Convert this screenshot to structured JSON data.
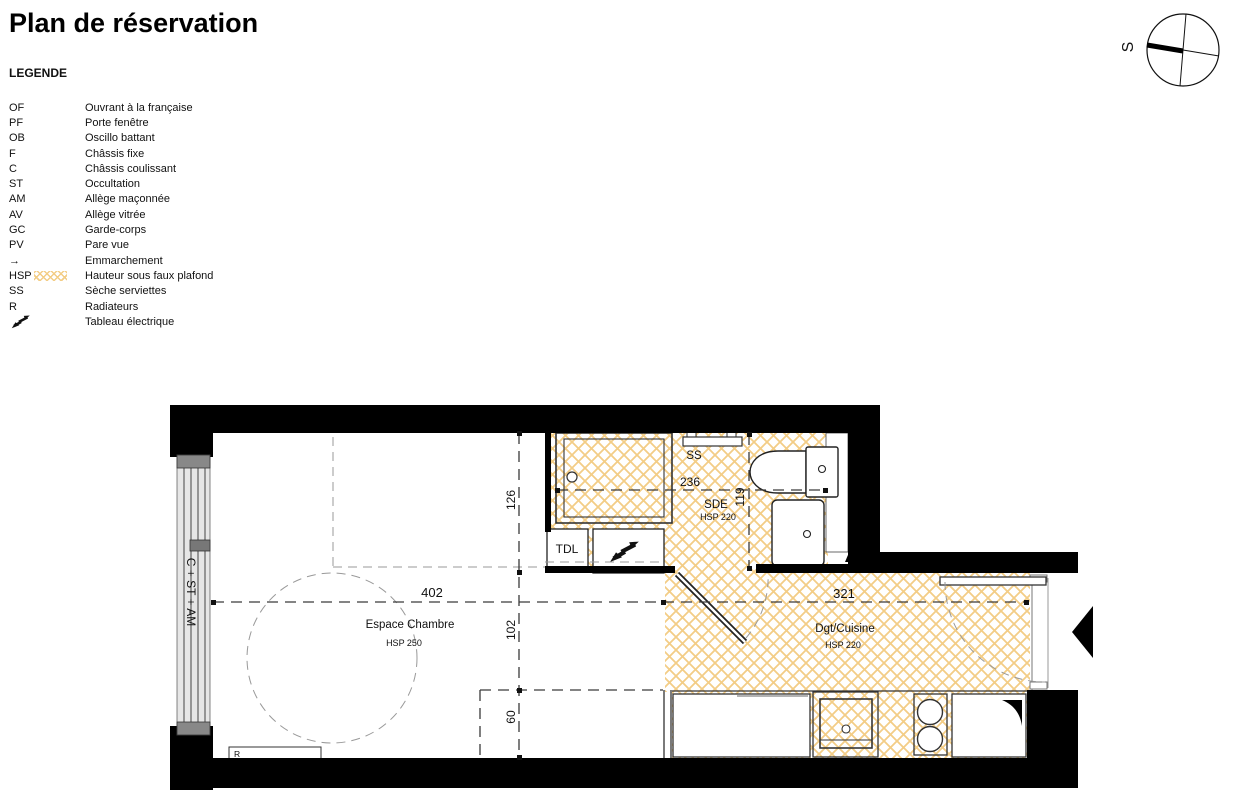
{
  "title": "Plan de réservation",
  "legend": {
    "heading": "LEGENDE",
    "items": [
      {
        "code": "OF",
        "label": "Ouvrant à la française"
      },
      {
        "code": "PF",
        "label": "Porte fenêtre"
      },
      {
        "code": "OB",
        "label": "Oscillo battant"
      },
      {
        "code": "F",
        "label": "Châssis fixe"
      },
      {
        "code": "C",
        "label": "Châssis coulissant"
      },
      {
        "code": "ST",
        "label": "Occultation"
      },
      {
        "code": "AM",
        "label": "Allège maçonnée"
      },
      {
        "code": "AV",
        "label": "Allège vitrée"
      },
      {
        "code": "GC",
        "label": "Garde-corps"
      },
      {
        "code": "PV",
        "label": "Pare vue"
      },
      {
        "code": "→",
        "label": "Emmarchement"
      },
      {
        "code": "HSP",
        "label": "Hauteur sous faux plafond",
        "swatch": "hatch"
      },
      {
        "code": "SS",
        "label": "Sèche serviettes"
      },
      {
        "code": "R",
        "label": "Radiateurs"
      },
      {
        "code": "",
        "label": "Tableau électrique",
        "icon": "lightning-icon"
      }
    ]
  },
  "compass": {
    "south": "S"
  },
  "plan": {
    "rooms": {
      "chambre": {
        "name": "Espace Chambre",
        "hsp": "HSP 250"
      },
      "sde": {
        "name": "SDE",
        "hsp": "HSP 220"
      },
      "cuisine": {
        "name": "Dgt/Cuisine",
        "hsp": "HSP 220"
      }
    },
    "dims": {
      "chambre_w": "402",
      "cuisine_w": "321",
      "upper": "126",
      "middle": "102",
      "lower": "60",
      "sde_w": "236",
      "sde_h": "119"
    },
    "labels": {
      "window": "C + ST + AM",
      "ss": "SS",
      "tdl": "TDL",
      "radiator": "R"
    },
    "colors": {
      "hatch": "#f3cd86",
      "wall": "#000000"
    }
  }
}
